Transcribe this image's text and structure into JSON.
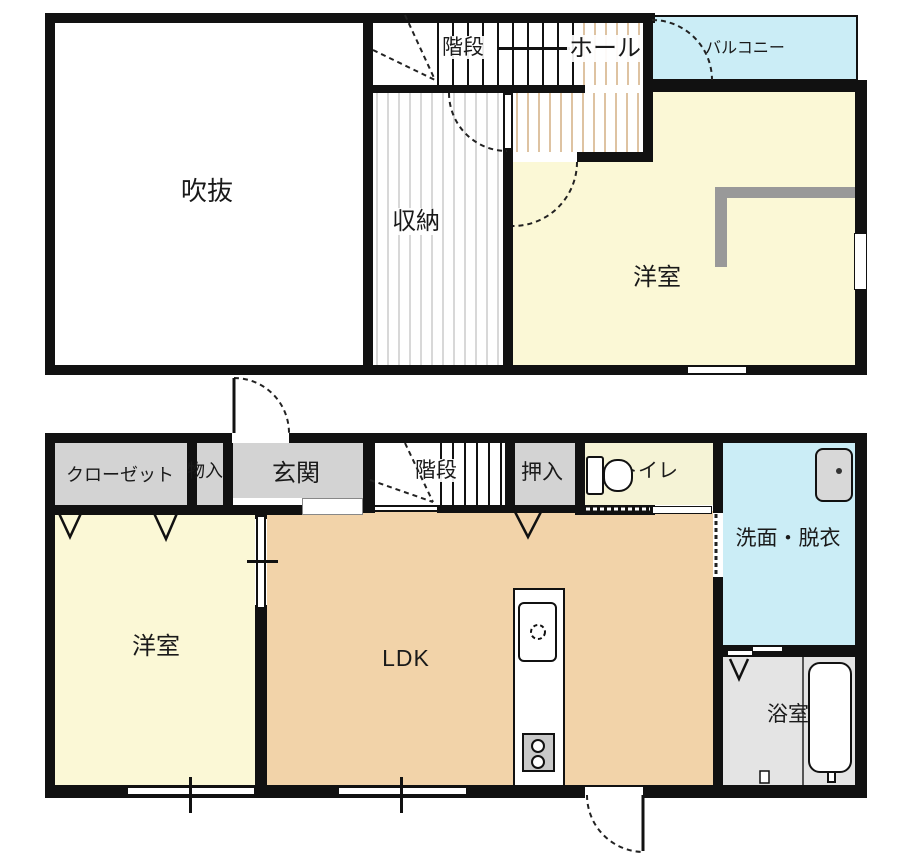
{
  "title": "2-story house floor plan",
  "floor2": {
    "void_label": "吹抜",
    "storage_label": "収納",
    "stairs_label": "階段",
    "hall_label": "ホール",
    "balcony_label": "バルコニー",
    "bedroom_label": "洋室"
  },
  "floor1": {
    "closet_label": "クローゼット",
    "small_storage_label": "物入",
    "entrance_label": "玄関",
    "stairs_label": "階段",
    "oshiire_label": "押入",
    "toilet_label": "トイレ",
    "washroom_label": "洗面・脱衣",
    "bedroom_label": "洋室",
    "ldk_label": "LDK",
    "bath_label": "浴室"
  },
  "icons": [
    "toilet-icon",
    "washbasin-icon",
    "bathtub-icon",
    "kitchen-sink-icon",
    "stove-icon",
    "door-swing-arc",
    "folding-door-mark",
    "sliding-door-mark",
    "stair-winder-dashes"
  ],
  "colors": {
    "wall": "#111111",
    "bedroom_yellow": "#fbf8d6",
    "toilet_yellow": "#f5f3d6",
    "ldk_tan": "#f2d3a9",
    "water_cyan": "#cbedf6",
    "closet_gray": "#d3d3d3",
    "bath_gray": "#e4e4e4",
    "stove_gray": "#c9c9c9",
    "rail_gray": "#999999"
  }
}
